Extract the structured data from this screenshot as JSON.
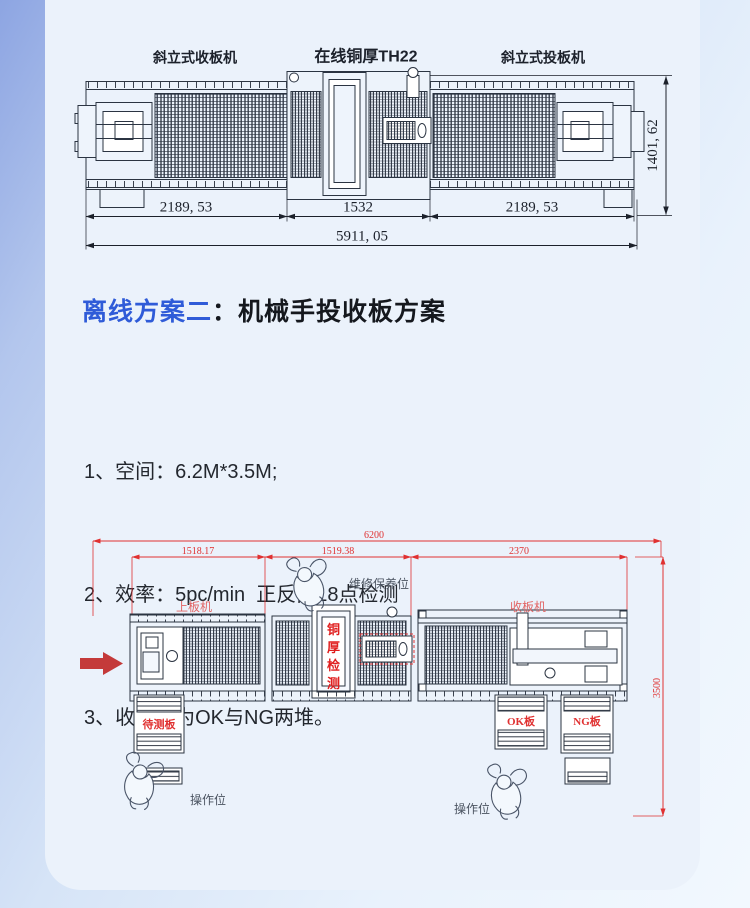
{
  "page": {
    "heading": {
      "highlight": "离线方案二",
      "rest": "：机械手投收板方案"
    },
    "list": {
      "items": [
        "1、空间：6.2M*3.5M;",
        "2、效率：5pc/min  正反面18点检测",
        "3、收板分为OK与NG两堆。"
      ]
    }
  },
  "top_drawing": {
    "labels": {
      "left_machine": "斜立式收板机",
      "center_machine": "在线铜厚TH22",
      "right_machine": "斜立式投板机"
    },
    "dims": {
      "left": "2189, 53",
      "center": "1532",
      "right": "2189, 53",
      "total": "5911, 05",
      "height": "1401, 62"
    }
  },
  "bottom_drawing": {
    "dims": {
      "total": "6200",
      "seg1": "1518.17",
      "seg2": "1519.38",
      "seg3": "2370",
      "height": "3500"
    },
    "labels": {
      "loader": "上板机",
      "maintenance": "维修保养位",
      "collector": "收板机",
      "tester_chars": [
        "铜",
        "厚",
        "检",
        "测"
      ],
      "pending_board": "待测板",
      "ok_board": "OK板",
      "ng_board": "NG板",
      "operator_left": "操作位",
      "operator_right": "操作位"
    }
  },
  "colors": {
    "accent_blue": "#2f5bd8",
    "dimension_red": "#e03131",
    "machine_label_red": "#e26565",
    "tester_text_red": "#e01f1f",
    "flow_arrow_red": "#c43a3a",
    "ink": "#2b3442",
    "card_background": "#ebf2fb"
  }
}
